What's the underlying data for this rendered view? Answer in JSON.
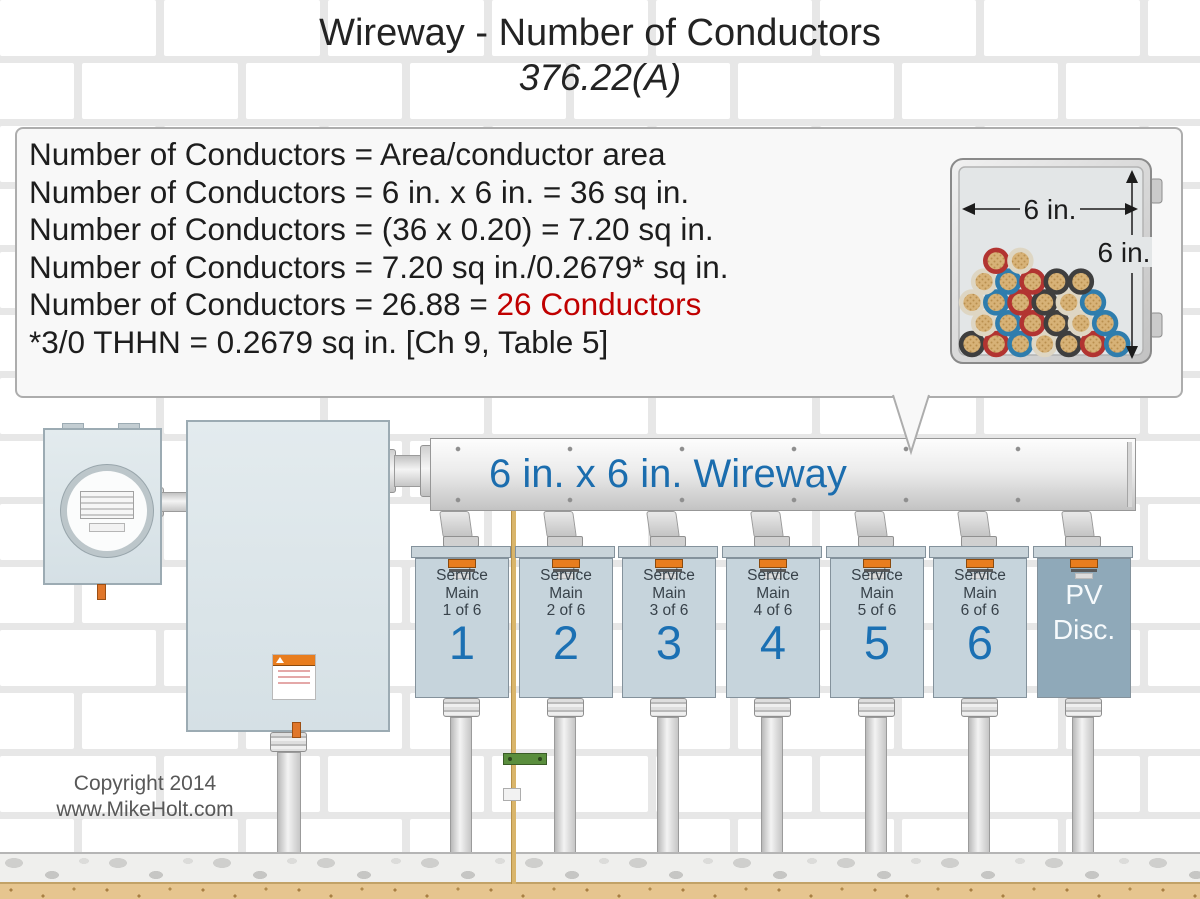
{
  "title": {
    "line1": "Wireway - Number of Conductors",
    "line2": "376.22(A)"
  },
  "calc": {
    "line1": "Number of Conductors = Area/conductor area",
    "line2": "Number of Conductors = 6 in. x 6 in. = 36 sq in.",
    "line3": "Number of Conductors = (36 x 0.20) = 7.20 sq in.",
    "line4": "Number of Conductors = 7.20 sq in./0.2679* sq in.",
    "line5_prefix": "Number of Conductors = 26.88 = ",
    "line5_highlight": "26 Conductors",
    "line6": "*3/0 THHN = 0.2679 sq in. [Ch 9, Table 5]",
    "highlight_color": "#c00000"
  },
  "cross_section": {
    "width_label": "6 in.",
    "height_label": "6 in.",
    "conductor_count": 26,
    "core_color": "#d7b277",
    "ring_palette": {
      "k": "#3f3f3f",
      "r": "#b23431",
      "b": "#2f7dad",
      "w": "#ded6c3"
    },
    "rows": [
      {
        "start": 0,
        "colors": [
          "k",
          "r",
          "b",
          "w",
          "k",
          "r",
          "b"
        ]
      },
      {
        "start": 0.5,
        "colors": [
          "w",
          "b",
          "r",
          "k",
          "w",
          "b"
        ]
      },
      {
        "start": 0,
        "colors": [
          "w",
          "b",
          "r",
          "k",
          "w",
          "b"
        ]
      },
      {
        "start": 0.5,
        "colors": [
          "w",
          "b",
          "r",
          "k",
          "k"
        ]
      },
      {
        "start": 1,
        "colors": [
          "r",
          "w"
        ]
      }
    ]
  },
  "wireway": {
    "label": "6 in. x 6 in. Wireway",
    "label_color": "#1b6dae"
  },
  "panels": [
    {
      "name": "service-main-panel-1",
      "lines": [
        "Service",
        "Main",
        "1 of 6"
      ],
      "number": "1",
      "pv": false
    },
    {
      "name": "service-main-panel-2",
      "lines": [
        "Service",
        "Main",
        "2 of 6"
      ],
      "number": "2",
      "pv": false
    },
    {
      "name": "service-main-panel-3",
      "lines": [
        "Service",
        "Main",
        "3 of 6"
      ],
      "number": "3",
      "pv": false
    },
    {
      "name": "service-main-panel-4",
      "lines": [
        "Service",
        "Main",
        "4 of 6"
      ],
      "number": "4",
      "pv": false
    },
    {
      "name": "service-main-panel-5",
      "lines": [
        "Service",
        "Main",
        "5 of 6"
      ],
      "number": "5",
      "pv": false
    },
    {
      "name": "service-main-panel-6",
      "lines": [
        "Service",
        "Main",
        "6 of 6"
      ],
      "number": "6",
      "pv": false
    },
    {
      "name": "pv-disconnect-panel",
      "lines": [
        "PV",
        "Disc."
      ],
      "number": null,
      "pv": true
    }
  ],
  "panel_number_color": "#1b70b3",
  "footer": {
    "line1": "Copyright 2014",
    "line2": "www.MikeHolt.com"
  }
}
